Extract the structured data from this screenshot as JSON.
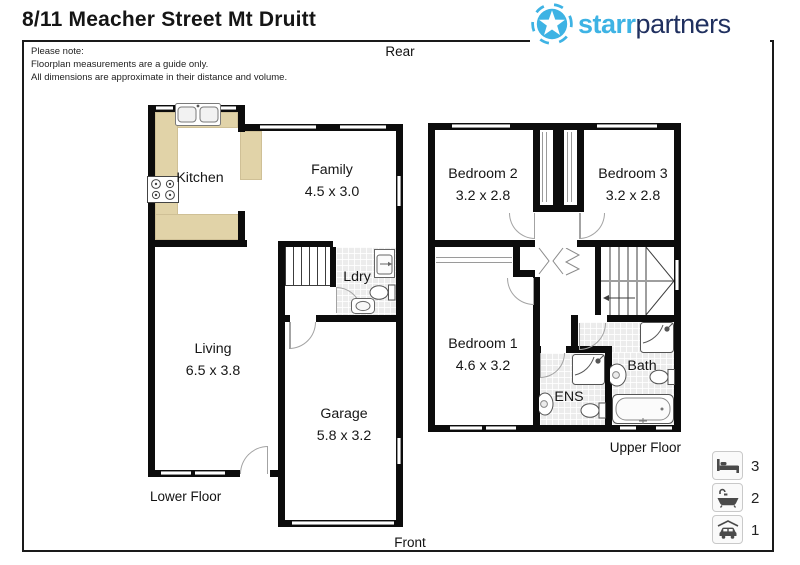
{
  "header": {
    "title": "8/11 Meacher Street Mt Druitt",
    "note": [
      "Please note:",
      "Floorplan measurements are a guide only.",
      "All dimensions are approximate in their distance and volume."
    ]
  },
  "logo": {
    "starr": "starr",
    "partners": "partners"
  },
  "compass": {
    "rear": "Rear",
    "front": "Front"
  },
  "floors": {
    "lower": {
      "label": "Lower Floor",
      "rooms": {
        "kitchen": {
          "name": "Kitchen"
        },
        "family": {
          "name": "Family",
          "dims": "4.5 x 3.0"
        },
        "laundry": {
          "name": "Ldry"
        },
        "living": {
          "name": "Living",
          "dims": "6.5 x 3.8"
        },
        "garage": {
          "name": "Garage",
          "dims": "5.8 x 3.2"
        }
      }
    },
    "upper": {
      "label": "Upper Floor",
      "rooms": {
        "bedroom2": {
          "name": "Bedroom 2",
          "dims": "3.2 x 2.8"
        },
        "bedroom3": {
          "name": "Bedroom 3",
          "dims": "3.2 x 2.8"
        },
        "bedroom1": {
          "name": "Bedroom 1",
          "dims": "4.6 x 3.2"
        },
        "ensuite": {
          "name": "ENS"
        },
        "bathroom": {
          "name": "Bath"
        }
      }
    }
  },
  "legend": {
    "items": [
      {
        "icon": "bed-icon",
        "count": "3"
      },
      {
        "icon": "bath-icon",
        "count": "2"
      },
      {
        "icon": "car-icon",
        "count": "1"
      }
    ]
  },
  "colors": {
    "logo_light_blue": "#3eb3e4",
    "logo_navy": "#20305f",
    "counter_tan": "#e1d3a8",
    "tile_grey": "#ececec",
    "wall_black": "#0c0c0c"
  }
}
